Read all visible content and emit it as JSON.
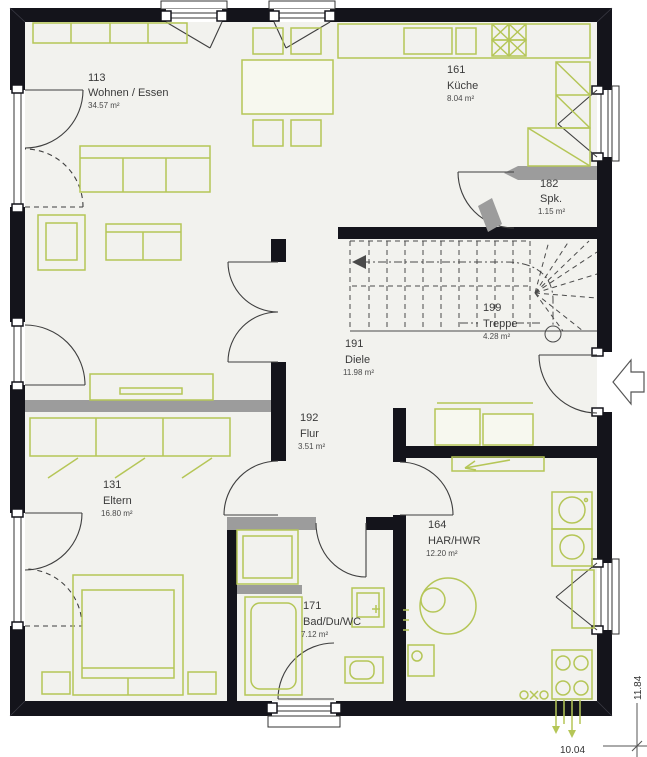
{
  "plan": {
    "title": "floor-plan",
    "rooms": [
      {
        "number": "113",
        "name": "Wohnen / Essen",
        "area": "34.57 m²"
      },
      {
        "number": "161",
        "name": "Küche",
        "area": "8.04 m²"
      },
      {
        "number": "182",
        "name": "Spk.",
        "area": "1.15 m²"
      },
      {
        "number": "199",
        "name": "Treppe",
        "area": "4.28 m²"
      },
      {
        "number": "191",
        "name": "Diele",
        "area": "11.98 m²"
      },
      {
        "number": "192",
        "name": "Flur",
        "area": "3.51 m²"
      },
      {
        "number": "131",
        "name": "Eltern",
        "area": "16.80 m²"
      },
      {
        "number": "164",
        "name": "HAR/HWR",
        "area": "12.20 m²"
      },
      {
        "number": "171",
        "name": "Bad/Du/WC",
        "area": "7.12 m²"
      }
    ],
    "dimensions": {
      "width": "10.04",
      "height": "11.84"
    },
    "colors": {
      "wall": "#14141b",
      "floor": "#f2f2ee",
      "furniture": "#b5c657",
      "gray_wall": "#9c9c9c"
    }
  }
}
